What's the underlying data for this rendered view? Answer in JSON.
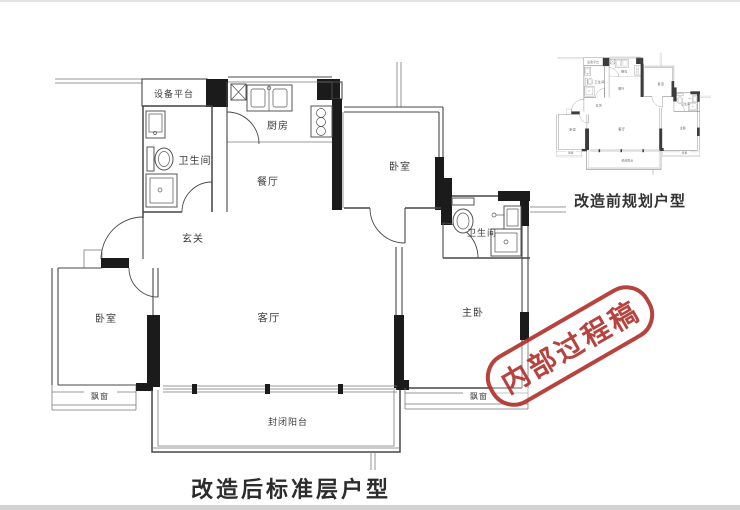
{
  "main_plan": {
    "caption": "改造后标准层户型",
    "labels": {
      "equipment_platform": "设备平台",
      "bathroom1": "卫生间",
      "kitchen": "厨房",
      "dining": "餐厅",
      "foyer": "玄关",
      "bedroom_mid": "卧室",
      "bathroom2": "卫生间",
      "living": "客厅",
      "bedroom_left": "卧室",
      "master_bedroom": "主卧",
      "bay_window_left": "飘窗",
      "bay_window_right": "飘窗",
      "balcony": "封闭阳台"
    }
  },
  "inset_plan": {
    "caption": "改造前规划户型"
  },
  "stamp": {
    "text": "内部过程稿",
    "color": "#b13530"
  },
  "colors": {
    "wall": "#474747",
    "wall_fill": "#1b1b1b",
    "label": "#3c3c3c",
    "caption": "#2c2c2c"
  }
}
